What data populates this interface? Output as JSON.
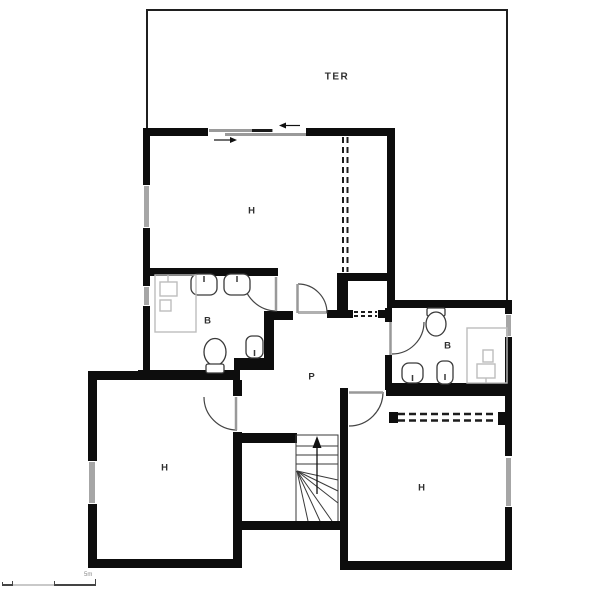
{
  "document": {
    "type": "architectural floor plan"
  },
  "rooms": {
    "terrace": "TER",
    "hall_top": "H",
    "bathroom_left": "B",
    "hallway_center": "P",
    "bathroom_right": "B",
    "room_bottom_left": "H",
    "room_bottom_right": "H"
  },
  "scale_bar": {
    "label": "5m"
  },
  "colors": {
    "background": "#ffffff",
    "wall": "#0d0d0d",
    "terrace_outline": "#1f1f1f",
    "window": "#a6a6a6",
    "door_leaf": "#999999",
    "door_arc": "#444444",
    "fixture_outline": "#3a3a3a",
    "furniture_outline": "#bdbdbd",
    "label_text": "#2f2f2f"
  }
}
